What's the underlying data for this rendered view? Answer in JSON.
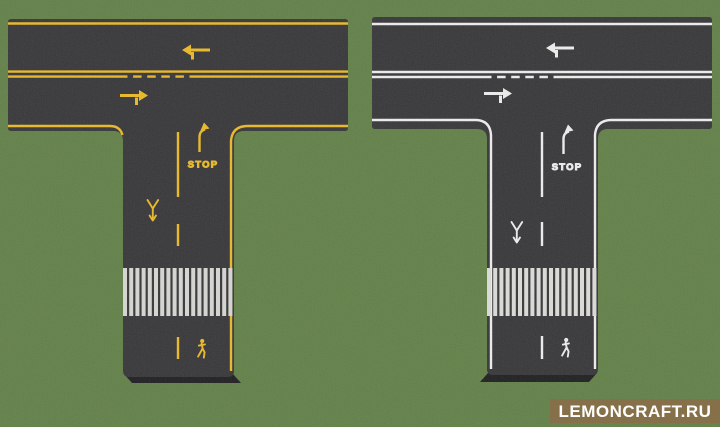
{
  "scene": {
    "description": "Top-down screenshot of two Minecraft T-shaped road intersection builds placed on a grass field",
    "width_px": 720,
    "height_px": 427
  },
  "colors": {
    "grass": "#5c7e3f",
    "asphalt": "#2d2d30",
    "asphalt_side": "#141417",
    "yellow_marking": "#e8b51c",
    "white_marking": "#ebebeb",
    "crosswalk_left": "#d3d3d0",
    "crosswalk_right": "#d8d8d5",
    "banner_bg": "#867049",
    "banner_text": "#ffffff"
  },
  "roads": {
    "left": {
      "name": "T-intersection road with yellow markings",
      "marking_color": "#e8b51c",
      "crosswalk_color": "#d3d3d0",
      "stop_label": "STOP",
      "markings": [
        "top-edge-line",
        "double-center-line-with-dashed-passing-zone",
        "left-turn-lane-arrow",
        "right-turn-lane-arrow",
        "lane-divider-dashes",
        "stop-ahead-turn-arrow",
        "stop-text",
        "yield-merge-symbol",
        "zebra-crosswalk",
        "pedestrian-symbol",
        "right-edge-line"
      ]
    },
    "right": {
      "name": "T-intersection road with white markings",
      "marking_color": "#ebebeb",
      "crosswalk_color": "#d8d8d5",
      "stop_label": "STOP",
      "markings": [
        "top-edge-line",
        "double-center-line-with-dashed-passing-zone",
        "left-turn-lane-arrow",
        "right-turn-lane-arrow",
        "lane-divider-dashes",
        "stop-ahead-turn-arrow",
        "stop-text",
        "yield-merge-symbol",
        "zebra-crosswalk",
        "pedestrian-symbol",
        "left-edge-line",
        "right-edge-line"
      ]
    }
  },
  "watermark": {
    "label": "LEMONCRAFT.RU"
  }
}
